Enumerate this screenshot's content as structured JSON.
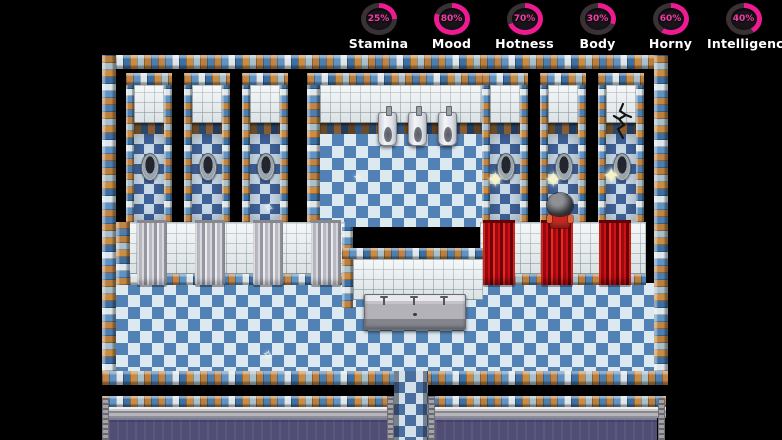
{
  "stats_bar": {
    "accent_color": "#ee1a92",
    "track_color": "#3a3134",
    "items": [
      {
        "label": "Stamina",
        "percent": 25,
        "percent_label": "25%"
      },
      {
        "label": "Mood",
        "percent": 80,
        "percent_label": "80%"
      },
      {
        "label": "Hotness",
        "percent": 70,
        "percent_label": "70%"
      },
      {
        "label": "Body",
        "percent": 30,
        "percent_label": "30%"
      },
      {
        "label": "Horny",
        "percent": 60,
        "percent_label": "60%"
      },
      {
        "label": "Intelligence",
        "percent": 40,
        "percent_label": "40%"
      }
    ]
  },
  "icons": {
    "sparkle_star": "✦",
    "sparkle_small": "✧"
  },
  "scene": {
    "description": "RPG-style bathroom map with shower stalls, urinals and sinks",
    "colors": {
      "wall_checker_orange": "#c08446",
      "wall_checker_blue": "#4c7fb0",
      "floor_blue": "#5282b5",
      "floor_light": "#dde9f1",
      "curtain_red": "#cf1018",
      "curtain_silver": "#c6c6cc",
      "lower_room_floor_purple": "#514e76"
    }
  }
}
